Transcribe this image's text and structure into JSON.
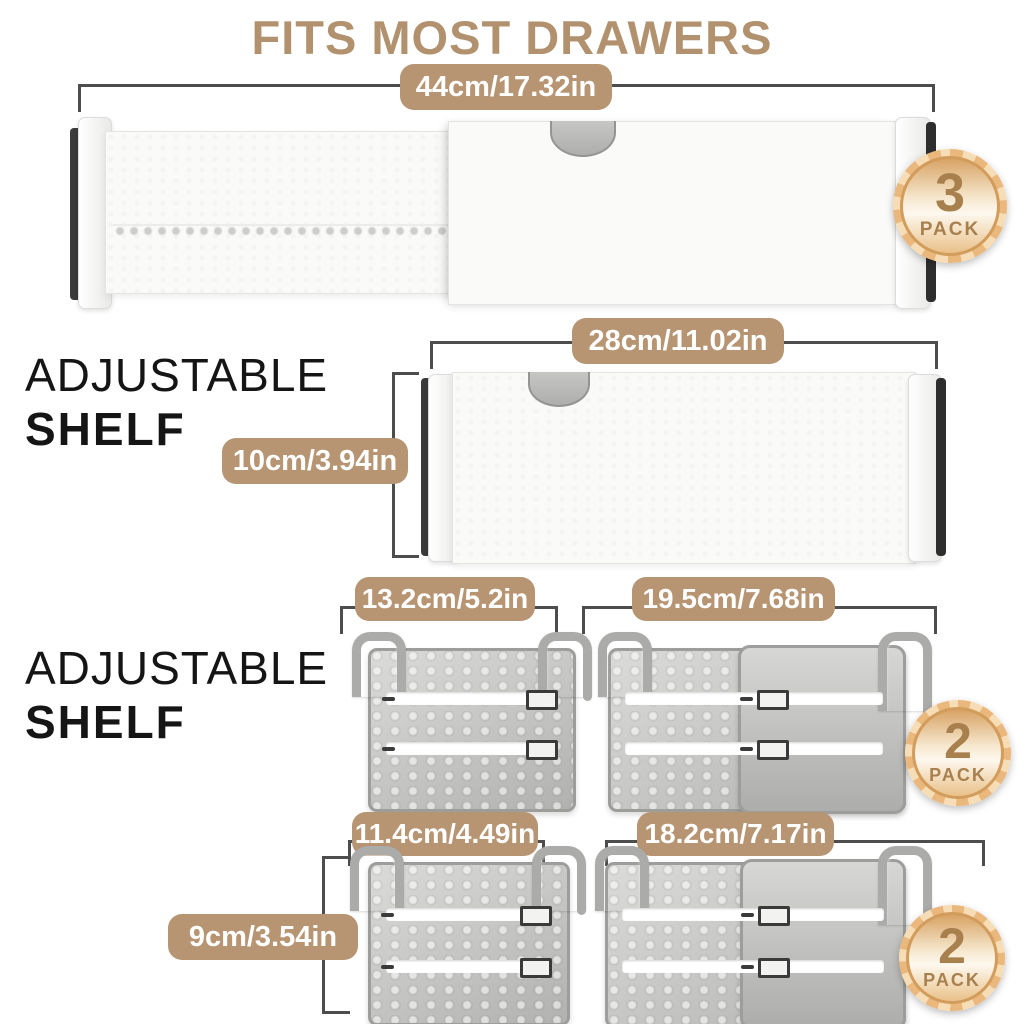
{
  "title": "FITS MOST DRAWERS",
  "sections": {
    "shelf1": {
      "label_line1": "ADJUSTABLE",
      "label_line2": "SHELF"
    },
    "shelf2": {
      "label_line1": "ADJUSTABLE",
      "label_line2": "SHELF"
    }
  },
  "dimensions": {
    "divider_width": "44cm/17.32in",
    "shelf1_width": "28cm/11.02in",
    "shelf1_height": "10cm/3.94in",
    "shelf2_item1_width": "13.2cm/5.2in",
    "shelf2_item2_width": "19.5cm/7.68in",
    "shelf2_item3_width": "11.4cm/4.49in",
    "shelf2_item3_height": "9cm/3.54in",
    "shelf2_item4_width": "18.2cm/7.17in"
  },
  "badges": {
    "divider_pack": {
      "count": "3",
      "label": "PACK"
    },
    "shelf_pack_row1": {
      "count": "2",
      "label": "PACK"
    },
    "shelf_pack_row2": {
      "count": "2",
      "label": "PACK"
    }
  },
  "colors": {
    "accent_tan": "#b79472",
    "title_tan": "#b2926e",
    "badge_text": "#a8804e",
    "dimension_line": "#4d4d4d"
  }
}
